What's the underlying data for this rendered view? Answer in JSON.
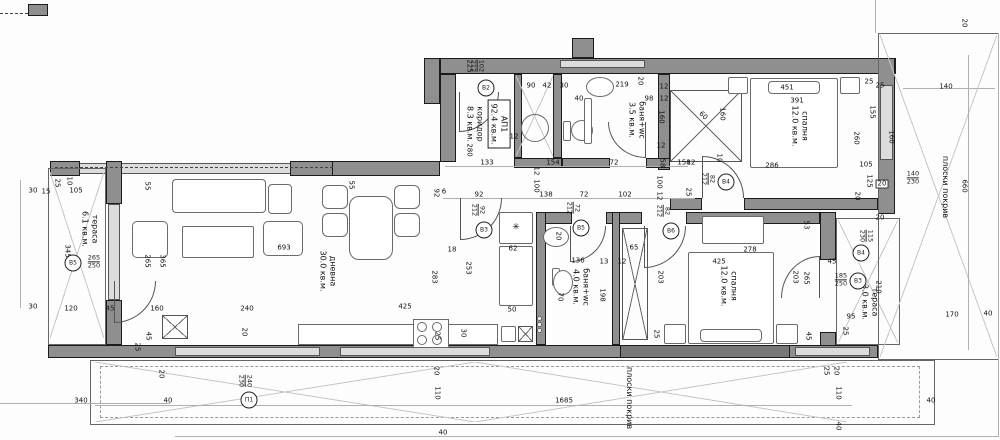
{
  "apartment": {
    "id": "АП1",
    "area": "92.4 кв.м."
  },
  "rooms": {
    "terrace_left": {
      "name": "тераса",
      "area": "6.1 кв.м."
    },
    "living": {
      "name": "дневна",
      "area": "30.0 кв.м."
    },
    "corridor": {
      "name": "коридор",
      "area": "8.3 кв.м."
    },
    "bath1": {
      "name": "баня+wc",
      "area": "3.5 кв.м."
    },
    "bedroom1": {
      "name": "спалня",
      "area": "12.0 кв.м."
    },
    "bath2": {
      "name": "баня+wc",
      "area": "4.0 кв.м."
    },
    "bedroom2": {
      "name": "спалня",
      "area": "12.0 кв.м."
    },
    "terrace_right": {
      "name": "тераса",
      "area": "3.0 кв.м."
    },
    "roof": {
      "name": "плоски покрив"
    }
  },
  "doors": [
    {
      "id": "В2",
      "w": "102",
      "h": "212"
    },
    {
      "id": "В3",
      "w": "92",
      "h": "212"
    },
    {
      "id": "В5",
      "w": "72",
      "h": "212"
    },
    {
      "id": "В6",
      "w": "82",
      "h": "212"
    },
    {
      "id": "В4",
      "w": "82",
      "h": "212"
    },
    {
      "id": "В5",
      "w": "265",
      "h": "250"
    },
    {
      "id": "В3",
      "w": "185",
      "h": "250"
    },
    {
      "id": "В4",
      "w": "115",
      "h": "230"
    },
    {
      "id": "П1",
      "w": "240",
      "h": "230"
    }
  ],
  "symbols": {
    "freezer": "✳"
  },
  "dims_top": [
    "225",
    "280",
    "90",
    "42",
    "30",
    "40",
    "12",
    "219",
    "20",
    "98",
    "12",
    "12",
    "160",
    "12",
    "58",
    "12",
    "60",
    "160",
    "25",
    "25",
    "451",
    "391",
    "286",
    "155",
    "260",
    "160",
    "105",
    "125",
    "20",
    "10",
    "25",
    "20",
    "20"
  ],
  "dims_hall": [
    "133",
    "154",
    "72",
    "158",
    "12",
    "100",
    "100",
    "12",
    "6",
    "92",
    "138",
    "72",
    "102",
    "92",
    "20",
    "18",
    "62"
  ],
  "dims_left": [
    "30",
    "15",
    "25",
    "10",
    "105",
    "345",
    "55",
    "55",
    "265",
    "365",
    "693",
    "30",
    "120",
    "45",
    "160",
    "240",
    "20",
    "45",
    "25",
    "425",
    "283",
    "253",
    "25",
    "30",
    "50"
  ],
  "dims_low": [
    "136",
    "13",
    "12",
    "65",
    "70",
    "198",
    "278",
    "425",
    "203",
    "203",
    "53",
    "265",
    "45",
    "45",
    "25",
    "95",
    "210",
    "25",
    "20"
  ],
  "dims_right": [
    "140",
    "140",
    "230",
    "660",
    "170",
    "40"
  ],
  "dims_bottom": [
    "340",
    "40",
    "20",
    "1685",
    "20",
    "110",
    "25",
    "20",
    "110",
    "40",
    "40",
    "40"
  ]
}
